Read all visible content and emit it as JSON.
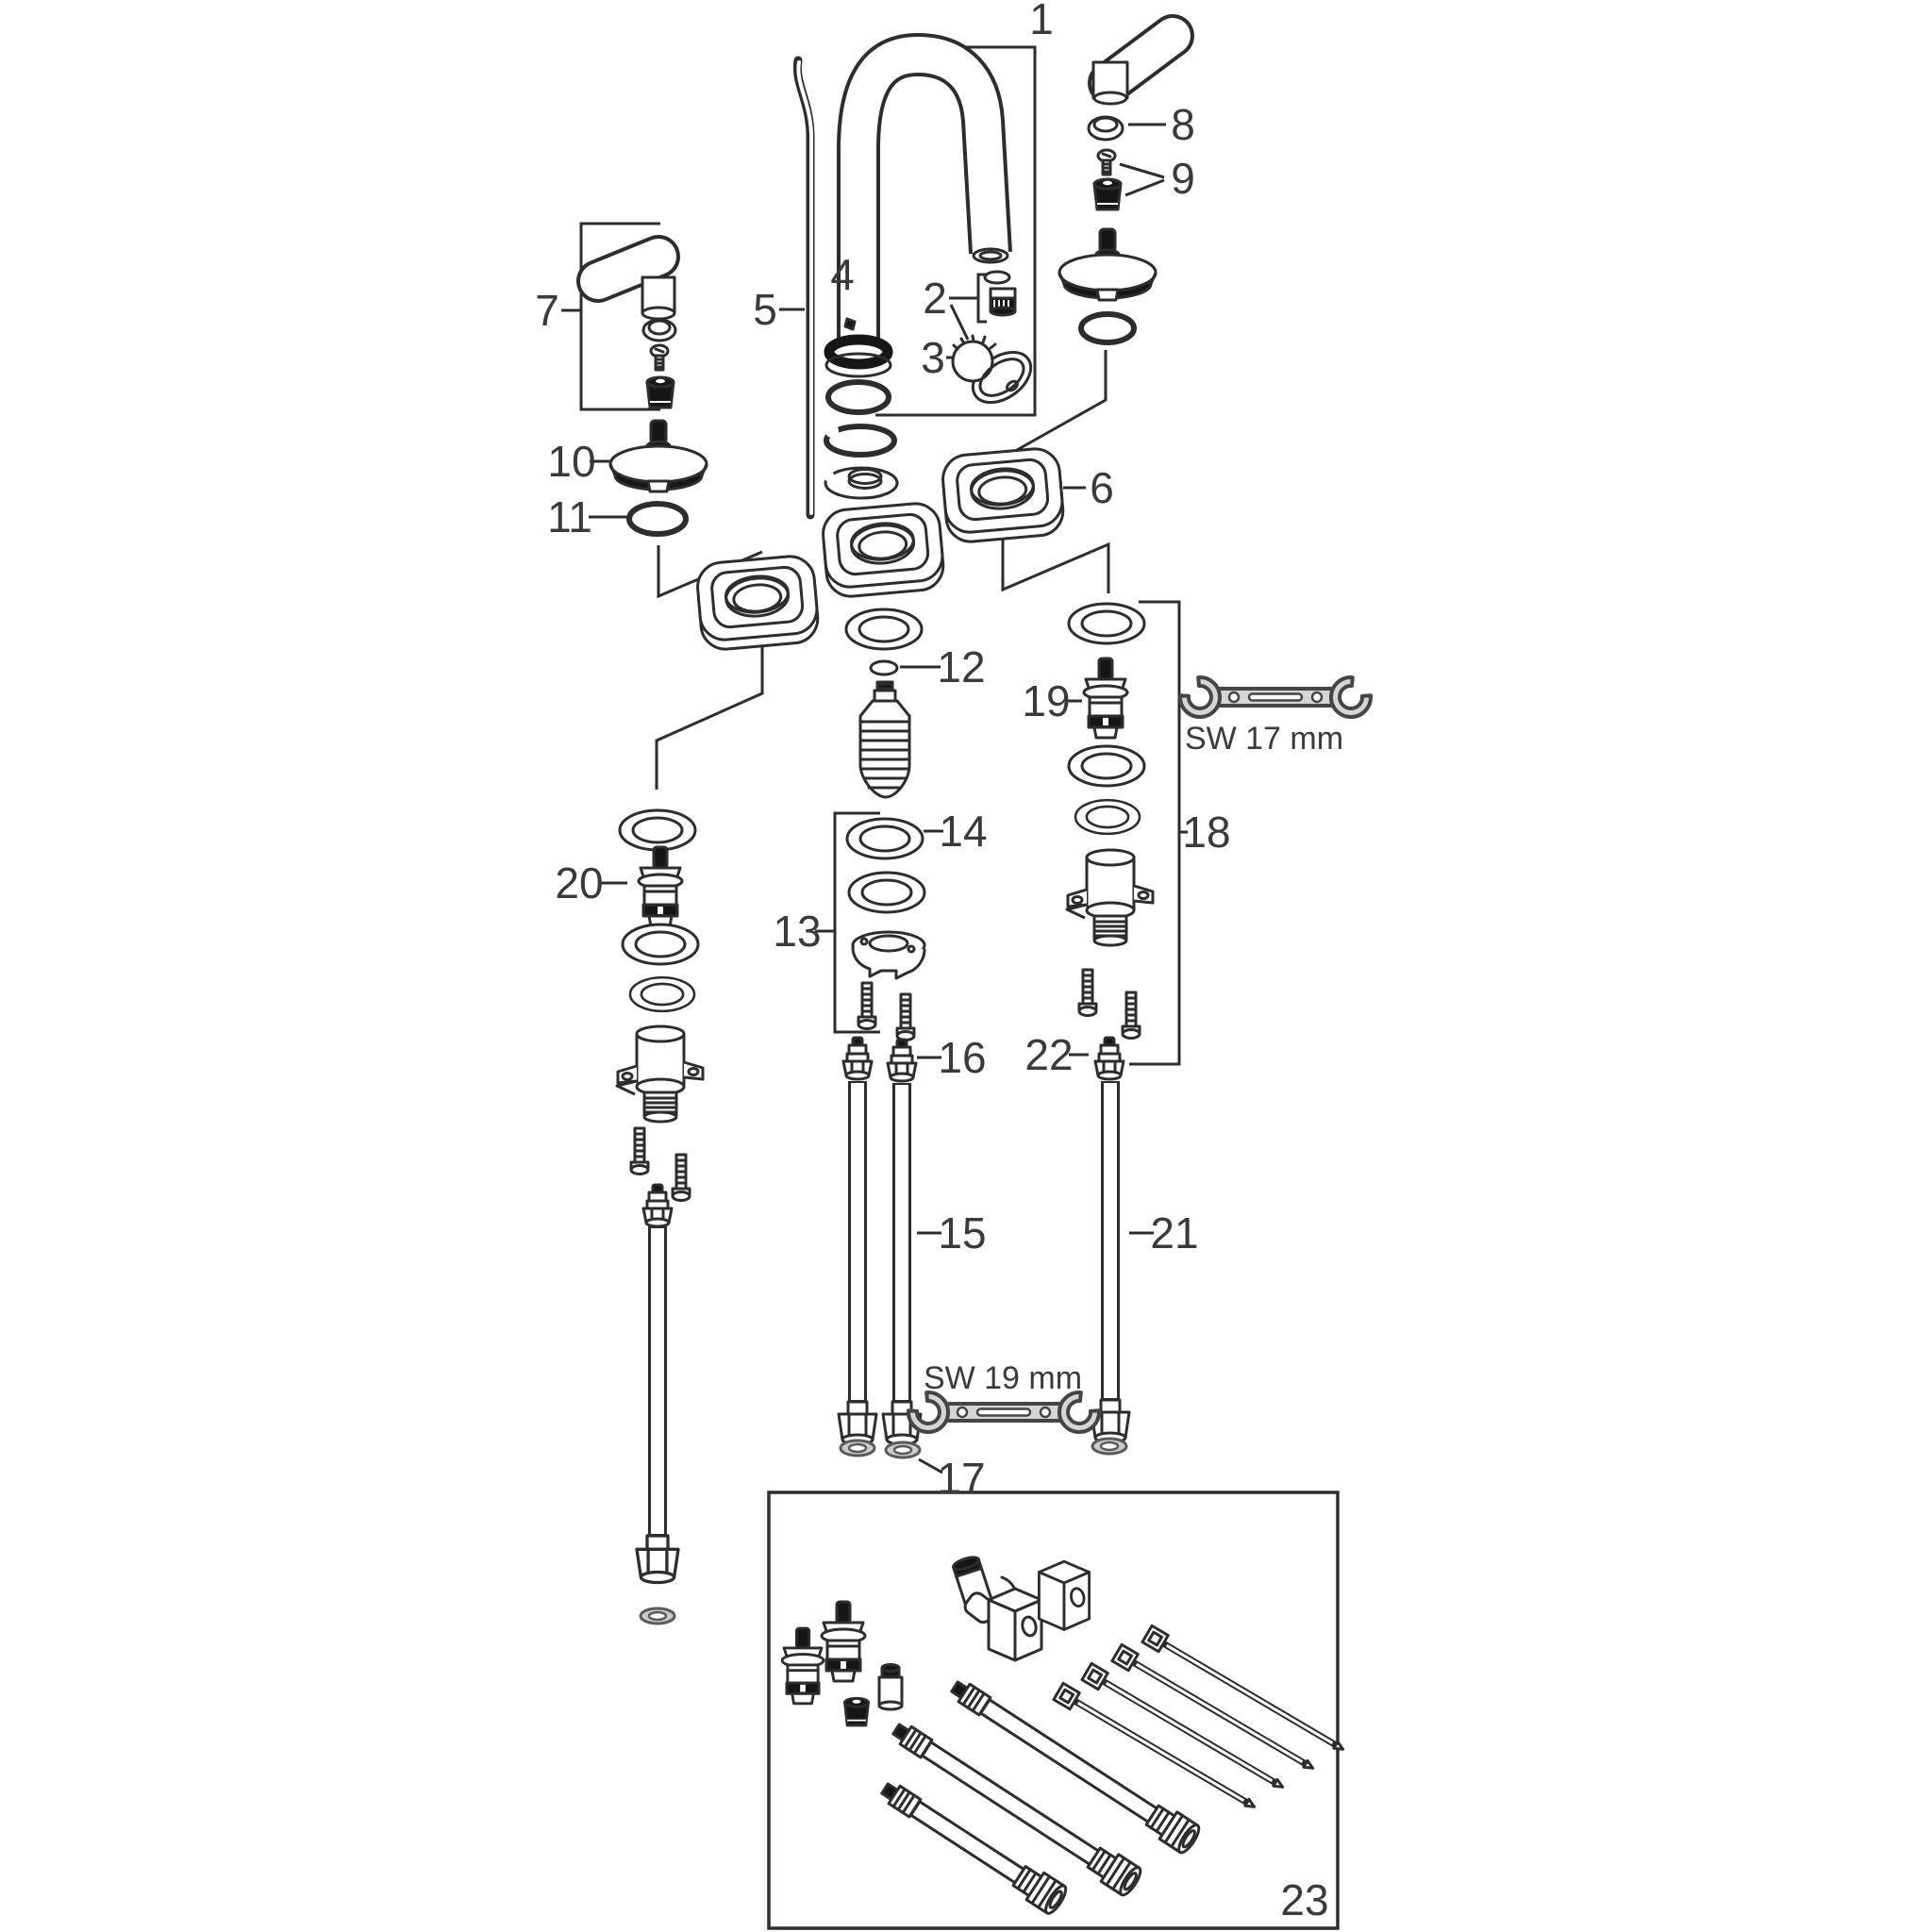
{
  "diagram": {
    "type": "exploded-parts-diagram",
    "callouts": {
      "c1": {
        "text": "1"
      },
      "c2": {
        "text": "2"
      },
      "c3": {
        "text": "3"
      },
      "c4": {
        "text": "4"
      },
      "c5": {
        "text": "5"
      },
      "c6": {
        "text": "6"
      },
      "c7": {
        "text": "7"
      },
      "c8": {
        "text": "8"
      },
      "c9": {
        "text": "9"
      },
      "c10": {
        "text": "10"
      },
      "c11": {
        "text": "11"
      },
      "c12": {
        "text": "12"
      },
      "c13": {
        "text": "13"
      },
      "c14": {
        "text": "14"
      },
      "c15": {
        "text": "15"
      },
      "c16": {
        "text": "16"
      },
      "c17": {
        "text": "17"
      },
      "c18": {
        "text": "18"
      },
      "c19": {
        "text": "19"
      },
      "c20": {
        "text": "20"
      },
      "c21": {
        "text": "21"
      },
      "c22": {
        "text": "22"
      },
      "c23": {
        "text": "23"
      }
    },
    "tools": {
      "sw17": {
        "text": "SW 17 mm"
      },
      "sw19": {
        "text": "SW 19 mm"
      }
    },
    "colors": {
      "line": "#2d2d2d",
      "label": "#3a3a3a",
      "black_part": "#161616",
      "tool_fill": "#d3d5d6",
      "tool_stroke": "#454545",
      "washer_fill": "#c9cbcc",
      "gray_stroke": "#5a5a5a",
      "background": "#ffffff"
    }
  }
}
